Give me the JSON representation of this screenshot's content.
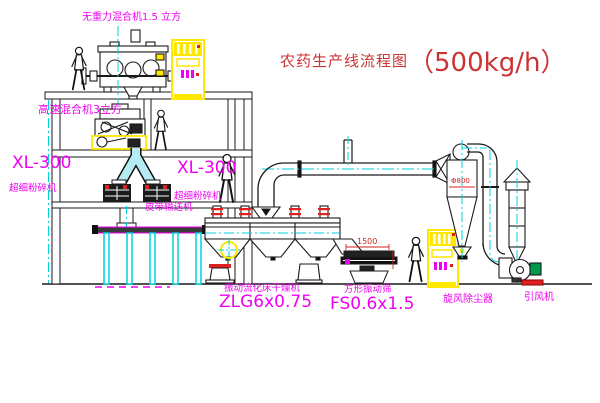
{
  "title": {
    "text": "农药生产线流程图",
    "capacity": "（500kg/h）"
  },
  "labels": {
    "top_mixer": "无重力混合机1.5 立方",
    "high_speed_mixer": "高速混合机3立方",
    "mill_left_model": "XL-300",
    "mill_left_name": "超细粉碎机",
    "mill_right_model": "XL-300",
    "mill_right_name": "超细粉碎机",
    "belt_conveyor": "皮带输送机",
    "dryer_name": "振动流化床干燥机",
    "dryer_model": "ZLG6x0.75",
    "screen_name": "方形振动筛",
    "screen_model": "FS0.6x1.5",
    "cyclone_name": "旋风除尘器",
    "fan_name": "引风机"
  },
  "dimensions": {
    "screen_length": "1500",
    "cyclone_diameter": "Φ800"
  },
  "colors": {
    "label_magenta": "#f000f0",
    "title_red": "#cc3333",
    "line_black": "#1a1a1a",
    "centerline_cyan": "#00d2dc",
    "duct_fill_cyan": "#b5ecf4",
    "highlight_yellow": "#ffe800",
    "flange_red": "#e02020",
    "motor_green": "#009a4e"
  }
}
